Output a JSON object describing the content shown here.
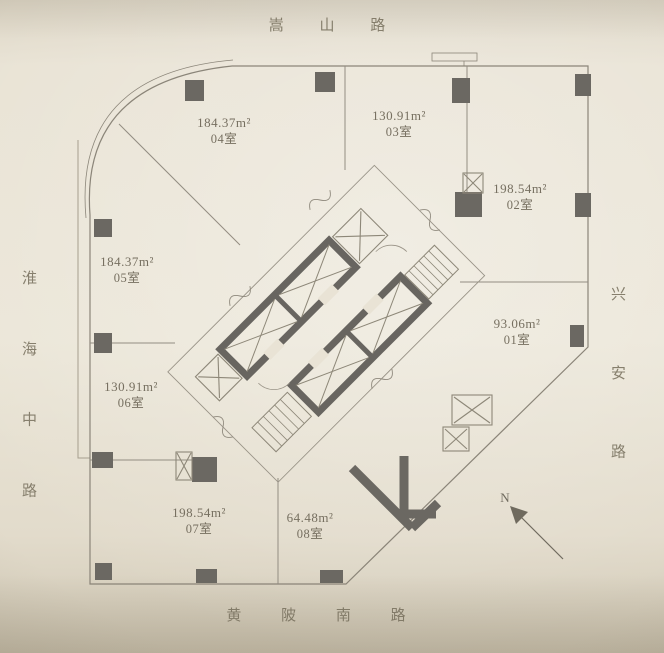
{
  "streets": {
    "top": "嵩 山 路",
    "left": "淮 海 中 路",
    "right": "兴 安 路",
    "bottom": "黄 陂 南 路"
  },
  "rooms": [
    {
      "id": "01",
      "area": "93.06m²",
      "name": "01室"
    },
    {
      "id": "02",
      "area": "198.54m²",
      "name": "02室"
    },
    {
      "id": "03",
      "area": "130.91m²",
      "name": "03室"
    },
    {
      "id": "04",
      "area": "184.37m²",
      "name": "04室"
    },
    {
      "id": "05",
      "area": "184.37m²",
      "name": "05室"
    },
    {
      "id": "06",
      "area": "130.91m²",
      "name": "06室"
    },
    {
      "id": "07",
      "area": "198.54m²",
      "name": "07室"
    },
    {
      "id": "08",
      "area": "64.48m²",
      "name": "08室"
    }
  ],
  "compass": {
    "label": "N"
  },
  "colors": {
    "paper": "#e9e3d5",
    "outline": "#8b8579",
    "wall_dark": "#6b6862",
    "text": "#766f60",
    "street_text": "#867f6d"
  }
}
